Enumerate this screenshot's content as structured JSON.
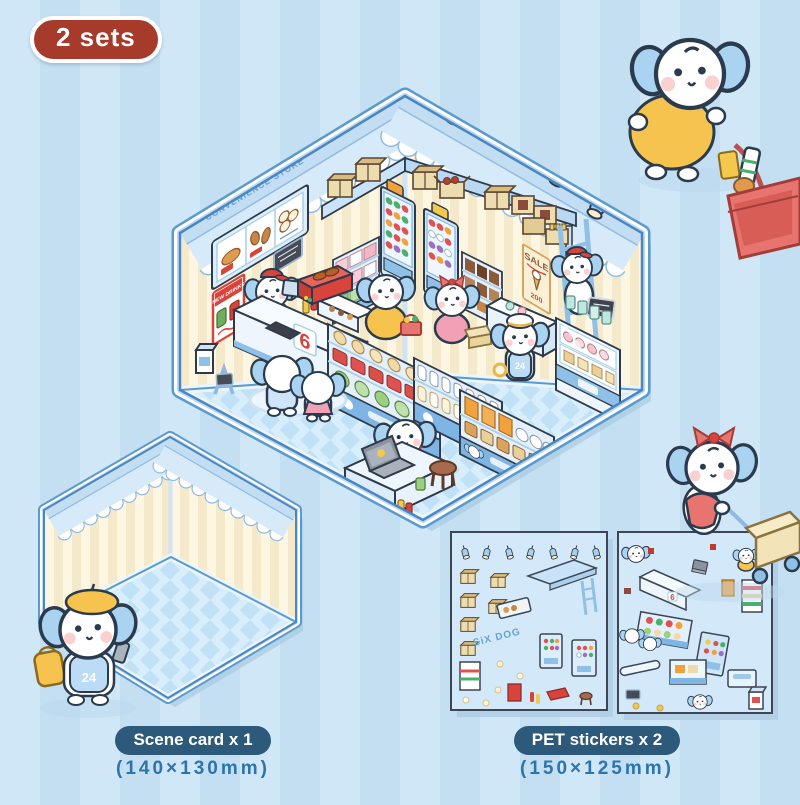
{
  "badge": {
    "label": "2 sets"
  },
  "store": {
    "name": "SiX DOG",
    "tagline": "CONVENIENCE STORE",
    "counter_number": "6",
    "staff_number": "24"
  },
  "posters": {
    "sale_title": "SALE",
    "sale_price": "200",
    "new_drinks": "NEW DRINKS"
  },
  "product_labels": {
    "scene_card": {
      "title": "Scene card x 1",
      "size": "(140×130mm)"
    },
    "pet_stickers": {
      "title": "PET stickers x 2",
      "size": "(150×125mm)"
    }
  },
  "colors": {
    "background": "#cbe3f5",
    "badge": "#a63b2c",
    "label_pill": "#2d5a7a",
    "label_size_text": "#2e74ac",
    "frame": "#5b9ace",
    "wall": "#fdf6e2",
    "awning": "#d6eaf9",
    "floor": "#d8eefc",
    "dog_ear": "#a9d3f1",
    "accent_red": "#d8433b",
    "accent_yellow": "#f5c34e",
    "accent_pink": "#f2a0b5"
  }
}
